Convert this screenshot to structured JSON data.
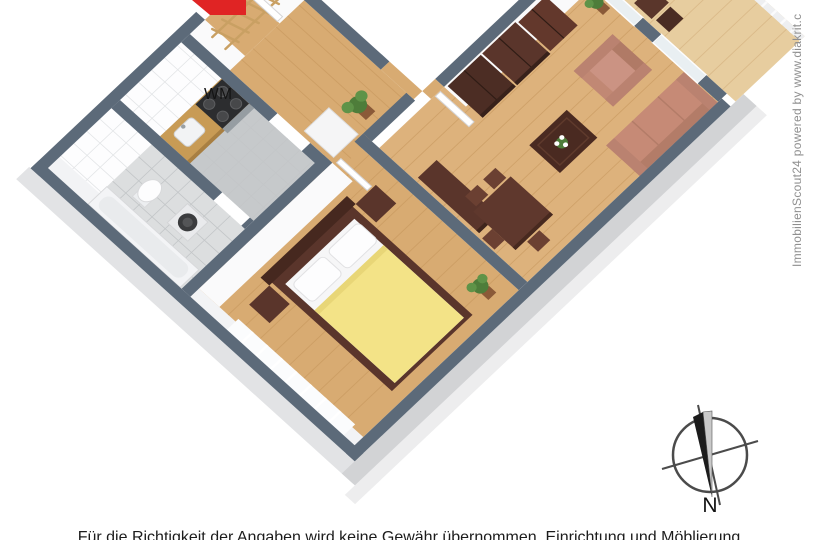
{
  "branding": {
    "watermark_vertical": "ImmobilienScout24 powered by www.diakrit.c"
  },
  "labels": {
    "washing_machine": "WM",
    "compass_north": "N"
  },
  "footer": {
    "disclaimer": "Für die Richtigkeit der Angaben wird keine Gewähr übernommen. Einrichtung und Möblierung"
  },
  "colors": {
    "wall_top": "#5c6a79",
    "wall_face": "#fafafb",
    "wall_outer": "#d2d3d5",
    "wood_floor": "#d8ab72",
    "wood_floor_living": "#ddb27c",
    "balcony_floor": "#e7cd9f",
    "tile_bath": "#dcdedf",
    "tile_kitchen": "#c6c9cb",
    "counter": "#c89b55",
    "bed_duvet": "#f3e387",
    "sofa": "#c68a76",
    "armchair": "#c18874",
    "furniture_dark": "#5a352b",
    "logo_red": "#e02424",
    "plant_green": "#4e7d3a",
    "compass_ink": "#3f3f3f"
  }
}
